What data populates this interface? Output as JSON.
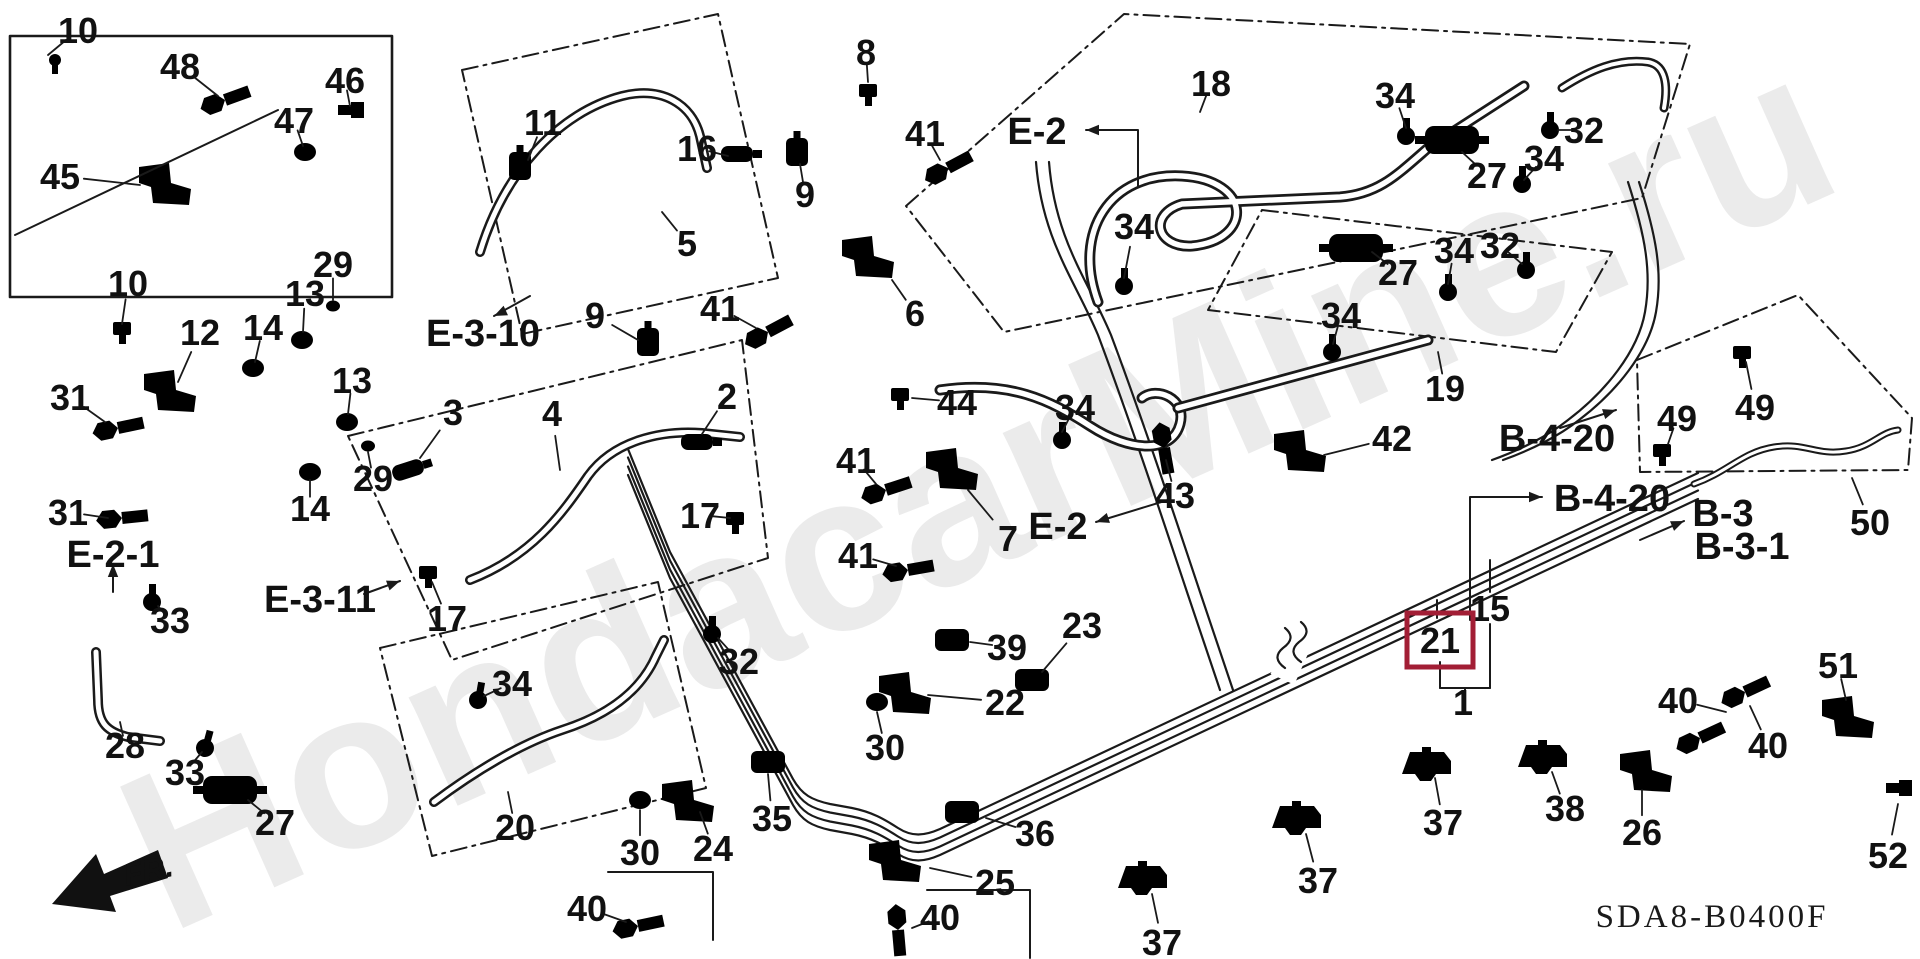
{
  "diagram": {
    "code": "SDA8-B0400F",
    "fr": "FR.",
    "watermark": "HondacarMine.ru",
    "ink_color": "#1a1a1a",
    "highlight": {
      "part": "21",
      "color": "#A21E35"
    },
    "part_labels": [
      {
        "n": "10",
        "x": 78,
        "y": 30,
        "lx": 48,
        "ly": 55
      },
      {
        "n": "48",
        "x": 180,
        "y": 66,
        "lx": 218,
        "ly": 96
      },
      {
        "n": "46",
        "x": 345,
        "y": 80,
        "lx": 350,
        "ly": 106
      },
      {
        "n": "47",
        "x": 294,
        "y": 120,
        "lx": 303,
        "ly": 146
      },
      {
        "n": "45",
        "x": 60,
        "y": 176,
        "lx": 140,
        "ly": 185
      },
      {
        "n": "10",
        "x": 128,
        "y": 283,
        "lx": 122,
        "ly": 324
      },
      {
        "n": "29",
        "x": 333,
        "y": 264,
        "lx": 333,
        "ly": 300
      },
      {
        "n": "13",
        "x": 305,
        "y": 293,
        "lx": 303,
        "ly": 332
      },
      {
        "n": "14",
        "x": 263,
        "y": 327,
        "lx": 255,
        "ly": 362
      },
      {
        "n": "12",
        "x": 200,
        "y": 332,
        "lx": 178,
        "ly": 382
      },
      {
        "n": "31",
        "x": 70,
        "y": 397,
        "lx": 105,
        "ly": 422
      },
      {
        "n": "13",
        "x": 352,
        "y": 380,
        "lx": 348,
        "ly": 414
      },
      {
        "n": "29",
        "x": 373,
        "y": 478,
        "lx": 368,
        "ly": 452
      },
      {
        "n": "14",
        "x": 310,
        "y": 508,
        "lx": 310,
        "ly": 480
      },
      {
        "n": "31",
        "x": 68,
        "y": 512,
        "lx": 108,
        "ly": 518
      },
      {
        "n": "33",
        "x": 170,
        "y": 620,
        "lx": 158,
        "ly": 606
      },
      {
        "n": "28",
        "x": 125,
        "y": 745,
        "lx": 120,
        "ly": 722
      },
      {
        "n": "33",
        "x": 185,
        "y": 772,
        "lx": 202,
        "ly": 752
      },
      {
        "n": "27",
        "x": 275,
        "y": 822,
        "lx": 248,
        "ly": 800
      },
      {
        "n": "11",
        "x": 543,
        "y": 122,
        "lx": 528,
        "ly": 160
      },
      {
        "n": "16",
        "x": 697,
        "y": 148,
        "lx": 728,
        "ly": 156
      },
      {
        "n": "5",
        "x": 687,
        "y": 243,
        "lx": 662,
        "ly": 212
      },
      {
        "n": "9",
        "x": 805,
        "y": 194,
        "lx": 800,
        "ly": 164
      },
      {
        "n": "9",
        "x": 595,
        "y": 315,
        "lx": 638,
        "ly": 340
      },
      {
        "n": "41",
        "x": 720,
        "y": 308,
        "lx": 756,
        "ly": 328
      },
      {
        "n": "41",
        "x": 925,
        "y": 133,
        "lx": 940,
        "ly": 160
      },
      {
        "n": "8",
        "x": 866,
        "y": 52,
        "lx": 868,
        "ly": 82
      },
      {
        "n": "6",
        "x": 915,
        "y": 313,
        "lx": 892,
        "ly": 280
      },
      {
        "n": "2",
        "x": 727,
        "y": 396,
        "lx": 702,
        "ly": 434
      },
      {
        "n": "44",
        "x": 957,
        "y": 402,
        "lx": 912,
        "ly": 398
      },
      {
        "n": "3",
        "x": 453,
        "y": 412,
        "lx": 420,
        "ly": 458
      },
      {
        "n": "4",
        "x": 552,
        "y": 413,
        "lx": 560,
        "ly": 470
      },
      {
        "n": "17",
        "x": 700,
        "y": 515,
        "lx": 730,
        "ly": 518
      },
      {
        "n": "17",
        "x": 447,
        "y": 618,
        "lx": 432,
        "ly": 582
      },
      {
        "n": "41",
        "x": 856,
        "y": 460,
        "lx": 876,
        "ly": 484
      },
      {
        "n": "41",
        "x": 858,
        "y": 555,
        "lx": 896,
        "ly": 566
      },
      {
        "n": "7",
        "x": 1008,
        "y": 538,
        "lx": 968,
        "ly": 490
      },
      {
        "n": "34",
        "x": 1075,
        "y": 407,
        "lx": 1062,
        "ly": 432
      },
      {
        "n": "43",
        "x": 1175,
        "y": 495,
        "lx": 1166,
        "ly": 460
      },
      {
        "n": "42",
        "x": 1392,
        "y": 438,
        "lx": 1324,
        "ly": 455
      },
      {
        "n": "23",
        "x": 1082,
        "y": 625,
        "lx": 1042,
        "ly": 672
      },
      {
        "n": "39",
        "x": 1007,
        "y": 647,
        "lx": 970,
        "ly": 642
      },
      {
        "n": "22",
        "x": 1005,
        "y": 702,
        "lx": 928,
        "ly": 695
      },
      {
        "n": "34",
        "x": 512,
        "y": 683,
        "lx": 484,
        "ly": 696
      },
      {
        "n": "32",
        "x": 739,
        "y": 661,
        "lx": 718,
        "ly": 638
      },
      {
        "n": "20",
        "x": 515,
        "y": 827,
        "lx": 508,
        "ly": 792
      },
      {
        "n": "30",
        "x": 640,
        "y": 852,
        "lx": 640,
        "ly": 810
      },
      {
        "n": "24",
        "x": 713,
        "y": 848,
        "lx": 700,
        "ly": 812
      },
      {
        "n": "35",
        "x": 772,
        "y": 818,
        "lx": 768,
        "ly": 774
      },
      {
        "n": "40",
        "x": 587,
        "y": 908,
        "lx": 626,
        "ly": 922
      },
      {
        "n": "30",
        "x": 885,
        "y": 747,
        "lx": 877,
        "ly": 712
      },
      {
        "n": "36",
        "x": 1035,
        "y": 833,
        "lx": 986,
        "ly": 818
      },
      {
        "n": "25",
        "x": 995,
        "y": 882,
        "lx": 930,
        "ly": 868
      },
      {
        "n": "40",
        "x": 940,
        "y": 917,
        "lx": 912,
        "ly": 928
      },
      {
        "n": "34",
        "x": 1134,
        "y": 226,
        "lx": 1124,
        "ly": 278
      },
      {
        "n": "18",
        "x": 1211,
        "y": 83,
        "lx": 1200,
        "ly": 112
      },
      {
        "n": "34",
        "x": 1395,
        "y": 95,
        "lx": 1406,
        "ly": 128
      },
      {
        "n": "27",
        "x": 1487,
        "y": 175,
        "lx": 1462,
        "ly": 152
      },
      {
        "n": "34",
        "x": 1544,
        "y": 158,
        "lx": 1524,
        "ly": 180
      },
      {
        "n": "32",
        "x": 1584,
        "y": 130,
        "lx": 1558,
        "ly": 130
      },
      {
        "n": "27",
        "x": 1398,
        "y": 272,
        "lx": 1372,
        "ly": 252
      },
      {
        "n": "34",
        "x": 1454,
        "y": 250,
        "lx": 1448,
        "ly": 284
      },
      {
        "n": "32",
        "x": 1500,
        "y": 245,
        "lx": 1522,
        "ly": 264
      },
      {
        "n": "34",
        "x": 1341,
        "y": 315,
        "lx": 1333,
        "ly": 344
      },
      {
        "n": "19",
        "x": 1445,
        "y": 388,
        "lx": 1438,
        "ly": 352
      },
      {
        "n": "49",
        "x": 1677,
        "y": 418,
        "lx": 1668,
        "ly": 444
      },
      {
        "n": "49",
        "x": 1755,
        "y": 407,
        "lx": 1746,
        "ly": 362
      },
      {
        "n": "50",
        "x": 1870,
        "y": 522,
        "lx": 1852,
        "ly": 478
      },
      {
        "n": "15",
        "x": 1490,
        "y": 608
      },
      {
        "n": "21",
        "x": 1440,
        "y": 640,
        "hl": true
      },
      {
        "n": "1",
        "x": 1463,
        "y": 702
      },
      {
        "n": "37",
        "x": 1443,
        "y": 822,
        "lx": 1435,
        "ly": 778
      },
      {
        "n": "38",
        "x": 1565,
        "y": 808,
        "lx": 1552,
        "ly": 772
      },
      {
        "n": "37",
        "x": 1318,
        "y": 880,
        "lx": 1306,
        "ly": 834
      },
      {
        "n": "37",
        "x": 1162,
        "y": 942,
        "lx": 1152,
        "ly": 894
      },
      {
        "n": "26",
        "x": 1642,
        "y": 832,
        "lx": 1642,
        "ly": 790
      },
      {
        "n": "40",
        "x": 1678,
        "y": 700,
        "lx": 1726,
        "ly": 712
      },
      {
        "n": "40",
        "x": 1768,
        "y": 745,
        "lx": 1750,
        "ly": 706
      },
      {
        "n": "51",
        "x": 1838,
        "y": 665,
        "lx": 1846,
        "ly": 700
      },
      {
        "n": "52",
        "x": 1888,
        "y": 855,
        "lx": 1898,
        "ly": 804
      }
    ],
    "ref_labels": [
      {
        "n": "E-3-10",
        "x": 483,
        "y": 332
      },
      {
        "n": "E-3-11",
        "x": 320,
        "y": 598
      },
      {
        "n": "E-2-1",
        "x": 113,
        "y": 553
      },
      {
        "n": "E-2",
        "x": 1037,
        "y": 130
      },
      {
        "n": "E-2",
        "x": 1058,
        "y": 525
      },
      {
        "n": "B-4-20",
        "x": 1557,
        "y": 437
      },
      {
        "n": "B-4-20",
        "x": 1612,
        "y": 497
      },
      {
        "n": "B-3",
        "x": 1723,
        "y": 512
      },
      {
        "n": "B-3-1",
        "x": 1742,
        "y": 545
      }
    ]
  }
}
